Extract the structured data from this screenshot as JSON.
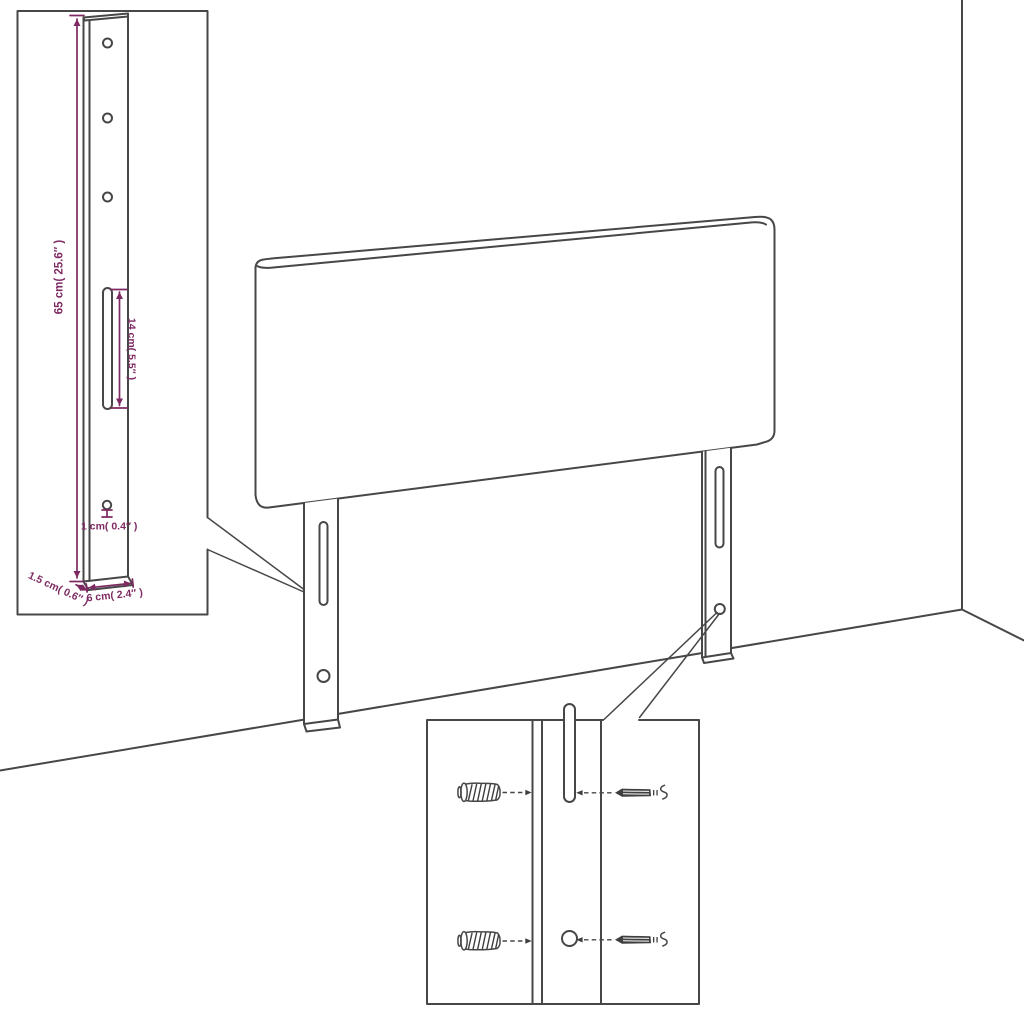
{
  "colors": {
    "background": "#ffffff",
    "outline": "#474747",
    "dimension_accent": "#7e2a62"
  },
  "leg_detail_callout": {
    "dim_height": "65 cm( 25.6″ )",
    "dim_slot_length": "14 cm( 5.5″ )",
    "dim_hole_diameter": "1 cm( 0.4″ )",
    "dim_thickness": "1.5 cm( 0.6″ )",
    "dim_width": "6 cm( 2.4″ )"
  },
  "mounting_detail_callout": {
    "icons": [
      "wall-anchor-icon",
      "screw-icon",
      "wall-anchor-icon",
      "screw-icon"
    ]
  }
}
